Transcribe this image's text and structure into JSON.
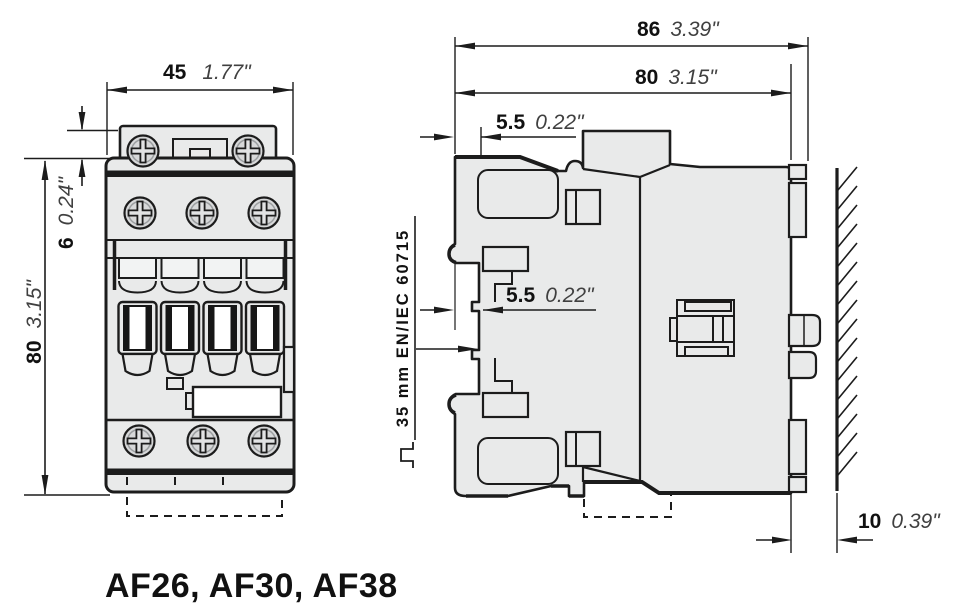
{
  "title": "AF26, AF30, AF38",
  "colors": {
    "body_fill": "#e9eaea",
    "line": "#1c1c1c",
    "mm_text": "#111111",
    "inch_text": "#404040",
    "white": "#ffffff"
  },
  "front_view": {
    "dim_width_mm": "45",
    "dim_width_in": "1.77\"",
    "dim_height_mm": "80",
    "dim_height_in": "3.15\"",
    "dim_top_mm": "6",
    "dim_top_in": "0.24\""
  },
  "side_view": {
    "dim_depth_total_mm": "86",
    "dim_depth_total_in": "3.39\"",
    "dim_depth_body_mm": "80",
    "dim_depth_body_in": "3.15\"",
    "dim_top_offset_mm": "5.5",
    "dim_top_offset_in": "0.22\"",
    "dim_rail_offset_mm": "5.5",
    "dim_rail_offset_in": "0.22\"",
    "din_rail_label": "35 mm EN/IEC 60715",
    "dim_wall_gap_mm": "10",
    "dim_wall_gap_in": "0.39\""
  }
}
